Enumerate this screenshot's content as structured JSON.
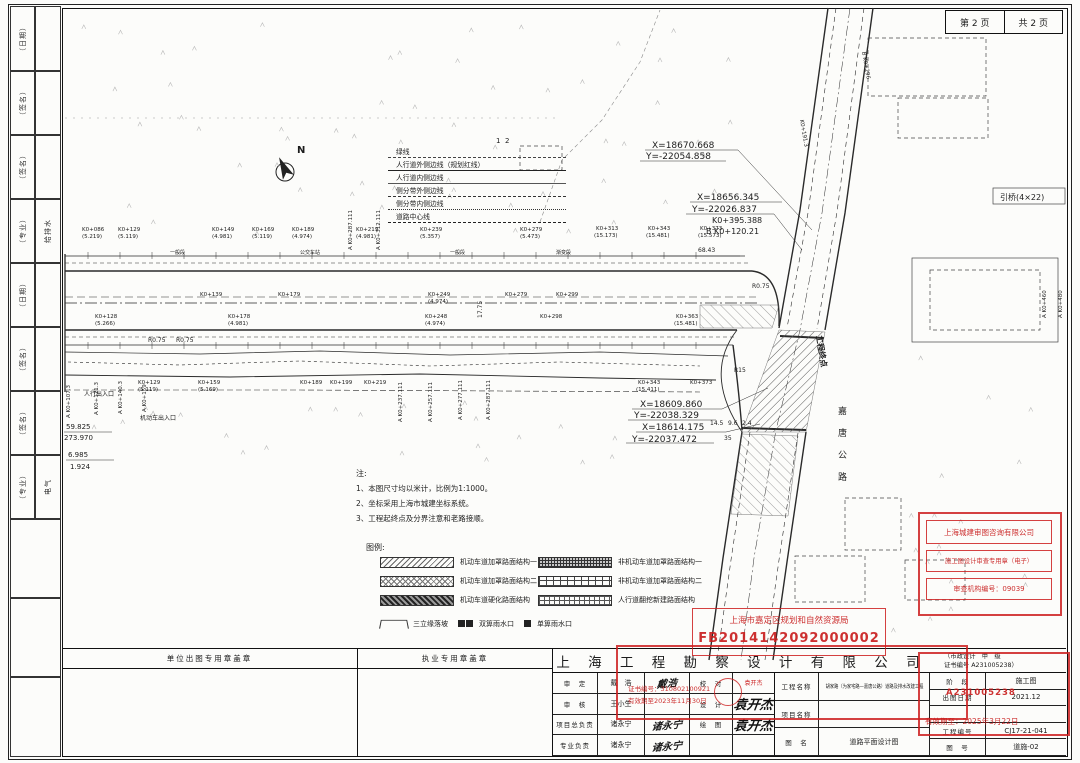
{
  "page": {
    "page_no": "第 2 页",
    "page_total": "共 2 页"
  },
  "left_strip": {
    "cells": [
      "（日期）",
      "（签名）",
      "（签名）",
      "（专业）",
      "（日期）",
      "（签名）",
      "（签名）",
      "（专业）"
    ],
    "col2": [
      {
        "i": 3,
        "t": "给排水"
      },
      {
        "i": 7,
        "t": "电气"
      }
    ]
  },
  "line_legend": {
    "rows": [
      {
        "label": "绿线",
        "style": "dashdot"
      },
      {
        "label": "人行道外侧边线（规划红线）",
        "style": "thick"
      },
      {
        "label": "人行道内侧边线",
        "style": "thin"
      },
      {
        "label": "侧分带外侧边线",
        "style": "dashed"
      },
      {
        "label": "侧分带内侧边线",
        "style": "dashed2"
      },
      {
        "label": "道路中心线",
        "style": "center"
      }
    ]
  },
  "notes": {
    "title": "注:",
    "items": [
      "1、本图尺寸均以米计，比例为1:1000。",
      "2、坐标采用上海市城建坐标系统。",
      "3、工程起终点及分界注意和老路接顺。"
    ]
  },
  "hatch_legend": {
    "title": "图例:",
    "col1": [
      {
        "pattern": "p-diag",
        "label": "机动车道加罩路面结构一"
      },
      {
        "pattern": "p-cross",
        "label": "机动车道加罩路面结构二"
      },
      {
        "pattern": "p-dense",
        "label": "机动车道硬化路面结构"
      }
    ],
    "col2": [
      {
        "pattern": "p-griddark",
        "label": "非机动车道加罩路面结构一"
      },
      {
        "pattern": "p-brick",
        "label": "非机动车道加罩路面结构二"
      },
      {
        "pattern": "p-grid",
        "label": "人行道翻挖新建路面结构"
      }
    ],
    "extras": [
      {
        "icon": "slope",
        "label": "三立缘落坡"
      },
      {
        "icon": "double-inlet",
        "label": "双箅雨水口"
      },
      {
        "icon": "single-inlet",
        "label": "单箅雨水口"
      }
    ]
  },
  "stamps": {
    "review": {
      "line1": "上海城建审图咨询有限公司",
      "line2": "施工图设计审查专用章（电子）",
      "line3": "审查机构编号：09039"
    },
    "planning": {
      "line1": "上海市嘉定区规划和自然资源局",
      "line2": "FB2014142092000002"
    },
    "reg": {
      "line1": "证书编号：310802100921",
      "line2": "有效期至2023年11月30日"
    },
    "validity": {
      "cert": "A231005238",
      "line": "有效期至：2025年3月22日"
    }
  },
  "titleblock": {
    "seal_area_left": "单位出图专用章盖章",
    "seal_area_right": "执业专用章盖章",
    "company": "上 海 工 程 勘 察 设 计 有 限 公 司",
    "cert_line1": "（市政设计　甲　级",
    "cert_line2": "证书编号 A231005238）",
    "rows": [
      {
        "label": "审　定",
        "name": "戴　浩",
        "sig": "戴浩",
        "label2": "校　对",
        "name2": "袁开杰",
        "n2c": "small-red"
      },
      {
        "label": "审　核",
        "name": "王小生",
        "sig": "",
        "label2": "设　计",
        "name2": "袁开杰",
        "n2c": "hand-big"
      },
      {
        "label": "项目总负责",
        "name": "诸永宁",
        "sig": "诸永宁",
        "label2": "绘　图",
        "name2": "袁开杰",
        "n2c": "hand-big"
      },
      {
        "label": "专业负责",
        "name": "诸永宁",
        "sig": "诸永宁",
        "label2": "",
        "name2": "",
        "n2c": ""
      }
    ],
    "project_label": "工程名称",
    "project_value": "胡家路（为家宅路—嘉唐公路）道路及排水改建工程",
    "item_label": "项目名称",
    "item_value": "",
    "fig_label": "图　名",
    "fig_value": "道路平面设计图",
    "stage_label": "阶　段",
    "stage_value": "施工图",
    "date_label": "出图日期",
    "date_value": "2021.12",
    "pno_label": "工程编号",
    "pno_value": "CJ17-21-041",
    "fno_label": "图　号",
    "fno_value": "道施-02"
  },
  "plan": {
    "labels": [
      {
        "t": "X=18670.668",
        "x": 652,
        "y": 148,
        "s": 9
      },
      {
        "t": "Y=-22054.858",
        "x": 646,
        "y": 159,
        "s": 9
      },
      {
        "t": "X=18656.345",
        "x": 697,
        "y": 200,
        "s": 9
      },
      {
        "t": "Y=-22026.837",
        "x": 692,
        "y": 212,
        "s": 9
      },
      {
        "t": "K0+395.388",
        "x": 712,
        "y": 223,
        "s": 8
      },
      {
        "t": "B K0+120.21",
        "x": 706,
        "y": 234,
        "s": 8
      },
      {
        "t": "X=18609.860",
        "x": 640,
        "y": 407,
        "s": 9
      },
      {
        "t": "Y=-22038.329",
        "x": 634,
        "y": 418,
        "s": 9
      },
      {
        "t": "X=18614.175",
        "x": 642,
        "y": 430,
        "s": 9
      },
      {
        "t": "Y=-22037.472",
        "x": 632,
        "y": 442,
        "s": 9
      },
      {
        "t": "引桥(4×22)",
        "x": 1000,
        "y": 200,
        "s": 8
      },
      {
        "t": "N",
        "x": 297,
        "y": 153,
        "s": 10,
        "b": 1
      },
      {
        "t": "嘉",
        "x": 838,
        "y": 414,
        "s": 9
      },
      {
        "t": "唐",
        "x": 838,
        "y": 436,
        "s": 9
      },
      {
        "t": "公",
        "x": 838,
        "y": 458,
        "s": 9
      },
      {
        "t": "路",
        "x": 838,
        "y": 480,
        "s": 9
      },
      {
        "t": "工程终点",
        "x": 816,
        "y": 336,
        "s": 8,
        "r": 80,
        "b": 1
      },
      {
        "t": "R0.75",
        "x": 752,
        "y": 288,
        "s": 6
      },
      {
        "t": "R0.75",
        "x": 148,
        "y": 342,
        "s": 6
      },
      {
        "t": "R0.75",
        "x": 176,
        "y": 342,
        "s": 6
      },
      {
        "t": "R15",
        "x": 734,
        "y": 372,
        "s": 6
      },
      {
        "t": "17.75",
        "x": 482,
        "y": 318,
        "s": 6,
        "r": -90
      },
      {
        "t": "68.43",
        "x": 698,
        "y": 252,
        "s": 6
      },
      {
        "t": "14.5",
        "x": 710,
        "y": 425,
        "s": 6
      },
      {
        "t": "9.6",
        "x": 728,
        "y": 425,
        "s": 6
      },
      {
        "t": "2.4",
        "x": 742,
        "y": 425,
        "s": 6
      },
      {
        "t": "35",
        "x": 724,
        "y": 440,
        "s": 6
      },
      {
        "t": "59.825",
        "x": 66,
        "y": 429,
        "s": 7
      },
      {
        "t": "273.970",
        "x": 64,
        "y": 440,
        "s": 7
      },
      {
        "t": "6.985",
        "x": 68,
        "y": 457,
        "s": 7
      },
      {
        "t": "1.924",
        "x": 70,
        "y": 469,
        "s": 7
      },
      {
        "t": "人行出入口",
        "x": 84,
        "y": 396,
        "s": 6
      },
      {
        "t": "机动车出入口",
        "x": 140,
        "y": 420,
        "s": 6
      },
      {
        "t": "一般段",
        "x": 170,
        "y": 254,
        "s": 5
      },
      {
        "t": "公交车站",
        "x": 300,
        "y": 254,
        "s": 5
      },
      {
        "t": "一般段",
        "x": 450,
        "y": 254,
        "s": 5
      },
      {
        "t": "渐变段",
        "x": 556,
        "y": 254,
        "s": 5
      },
      {
        "t": "1",
        "x": 496,
        "y": 143,
        "s": 7
      },
      {
        "t": "2",
        "x": 505,
        "y": 143,
        "s": 7
      },
      {
        "t": "K0+086",
        "x": 82,
        "y": 231,
        "s": 5.5
      },
      {
        "t": "(5.219)",
        "x": 82,
        "y": 238,
        "s": 5.5
      },
      {
        "t": "K0+129",
        "x": 118,
        "y": 231,
        "s": 5.5
      },
      {
        "t": "(5.119)",
        "x": 118,
        "y": 238,
        "s": 5.5
      },
      {
        "t": "K0+149",
        "x": 212,
        "y": 231,
        "s": 5.5
      },
      {
        "t": "(4.981)",
        "x": 212,
        "y": 238,
        "s": 5.5
      },
      {
        "t": "K0+169",
        "x": 252,
        "y": 231,
        "s": 5.5
      },
      {
        "t": "(5.119)",
        "x": 252,
        "y": 238,
        "s": 5.5
      },
      {
        "t": "K0+189",
        "x": 292,
        "y": 231,
        "s": 5.5
      },
      {
        "t": "(4.974)",
        "x": 292,
        "y": 238,
        "s": 5.5
      },
      {
        "t": "K0+219",
        "x": 356,
        "y": 231,
        "s": 5.5
      },
      {
        "t": "(4.981)",
        "x": 356,
        "y": 238,
        "s": 5.5
      },
      {
        "t": "K0+239",
        "x": 420,
        "y": 231,
        "s": 5.5
      },
      {
        "t": "(5.357)",
        "x": 420,
        "y": 238,
        "s": 5.5
      },
      {
        "t": "K0+279",
        "x": 520,
        "y": 231,
        "s": 5.5
      },
      {
        "t": "(5.473)",
        "x": 520,
        "y": 238,
        "s": 5.5
      },
      {
        "t": "K0+313",
        "x": 596,
        "y": 230,
        "s": 5.5
      },
      {
        "t": "(15.173)",
        "x": 594,
        "y": 237,
        "s": 5.5
      },
      {
        "t": "K0+343",
        "x": 648,
        "y": 230,
        "s": 5.5
      },
      {
        "t": "(15.481)",
        "x": 646,
        "y": 237,
        "s": 5.5
      },
      {
        "t": "K0+373",
        "x": 700,
        "y": 230,
        "s": 5.5
      },
      {
        "t": "(15.573)",
        "x": 698,
        "y": 237,
        "s": 5.5
      },
      {
        "t": "K0+139",
        "x": 200,
        "y": 296,
        "s": 5.5
      },
      {
        "t": "K0+179",
        "x": 278,
        "y": 296,
        "s": 5.5
      },
      {
        "t": "K0+249",
        "x": 428,
        "y": 296,
        "s": 5.5
      },
      {
        "t": "(4.974)",
        "x": 428,
        "y": 303,
        "s": 5.5
      },
      {
        "t": "K0+279",
        "x": 505,
        "y": 296,
        "s": 5.5
      },
      {
        "t": "K0+299",
        "x": 556,
        "y": 296,
        "s": 5.5
      },
      {
        "t": "K0+128",
        "x": 95,
        "y": 318,
        "s": 5.5
      },
      {
        "t": "(5.266)",
        "x": 95,
        "y": 325,
        "s": 5.5
      },
      {
        "t": "K0+178",
        "x": 228,
        "y": 318,
        "s": 5.5
      },
      {
        "t": "(4.981)",
        "x": 228,
        "y": 325,
        "s": 5.5
      },
      {
        "t": "K0+248",
        "x": 425,
        "y": 318,
        "s": 5.5
      },
      {
        "t": "(4.974)",
        "x": 425,
        "y": 325,
        "s": 5.5
      },
      {
        "t": "K0+298",
        "x": 540,
        "y": 318,
        "s": 5.5
      },
      {
        "t": "K0+363",
        "x": 676,
        "y": 318,
        "s": 5.5
      },
      {
        "t": "(15.481)",
        "x": 674,
        "y": 325,
        "s": 5.5
      },
      {
        "t": "K0+129",
        "x": 138,
        "y": 384,
        "s": 5.5
      },
      {
        "t": "(5.119)",
        "x": 138,
        "y": 391,
        "s": 5.5
      },
      {
        "t": "K0+159",
        "x": 198,
        "y": 384,
        "s": 5.5
      },
      {
        "t": "(5.169)",
        "x": 198,
        "y": 391,
        "s": 5.5
      },
      {
        "t": "K0+189",
        "x": 300,
        "y": 384,
        "s": 5.5
      },
      {
        "t": "K0+199",
        "x": 330,
        "y": 384,
        "s": 5.5
      },
      {
        "t": "K0+219",
        "x": 364,
        "y": 384,
        "s": 5.5
      },
      {
        "t": "K0+343",
        "x": 638,
        "y": 384,
        "s": 5.5
      },
      {
        "t": "(15.411)",
        "x": 636,
        "y": 391,
        "s": 5.5
      },
      {
        "t": "K0+373",
        "x": 690,
        "y": 384,
        "s": 5.5
      },
      {
        "t": "A K0+107.3",
        "x": 70,
        "y": 418,
        "s": 5.5,
        "r": -90
      },
      {
        "t": "A K0+121.3",
        "x": 98,
        "y": 415,
        "s": 5.5,
        "r": -90
      },
      {
        "t": "A K0+140.3",
        "x": 122,
        "y": 414,
        "s": 5.5,
        "r": -90
      },
      {
        "t": "A K0+159",
        "x": 146,
        "y": 412,
        "s": 5.5,
        "r": -90
      },
      {
        "t": "A K0+237.111",
        "x": 402,
        "y": 422,
        "s": 5.5,
        "r": -90
      },
      {
        "t": "A K0+257.111",
        "x": 432,
        "y": 422,
        "s": 5.5,
        "r": -90
      },
      {
        "t": "A K0+277.111",
        "x": 462,
        "y": 420,
        "s": 5.5,
        "r": -90
      },
      {
        "t": "A K0+287.111",
        "x": 490,
        "y": 420,
        "s": 5.5,
        "r": -90
      },
      {
        "t": "A K0+312.111",
        "x": 380,
        "y": 250,
        "s": 5.5,
        "r": -90
      },
      {
        "t": "A K0+287.111",
        "x": 352,
        "y": 250,
        "s": 5.5,
        "r": -90
      },
      {
        "t": "A K0+460",
        "x": 1046,
        "y": 318,
        "s": 5.5,
        "r": -90
      },
      {
        "t": "A K0+480",
        "x": 1062,
        "y": 318,
        "s": 5.5,
        "r": -90
      },
      {
        "t": "B K0+296",
        "x": 862,
        "y": 52,
        "s": 5.5,
        "r": 80
      },
      {
        "t": "K0+191.3",
        "x": 800,
        "y": 120,
        "s": 5.5,
        "r": 80
      }
    ]
  }
}
